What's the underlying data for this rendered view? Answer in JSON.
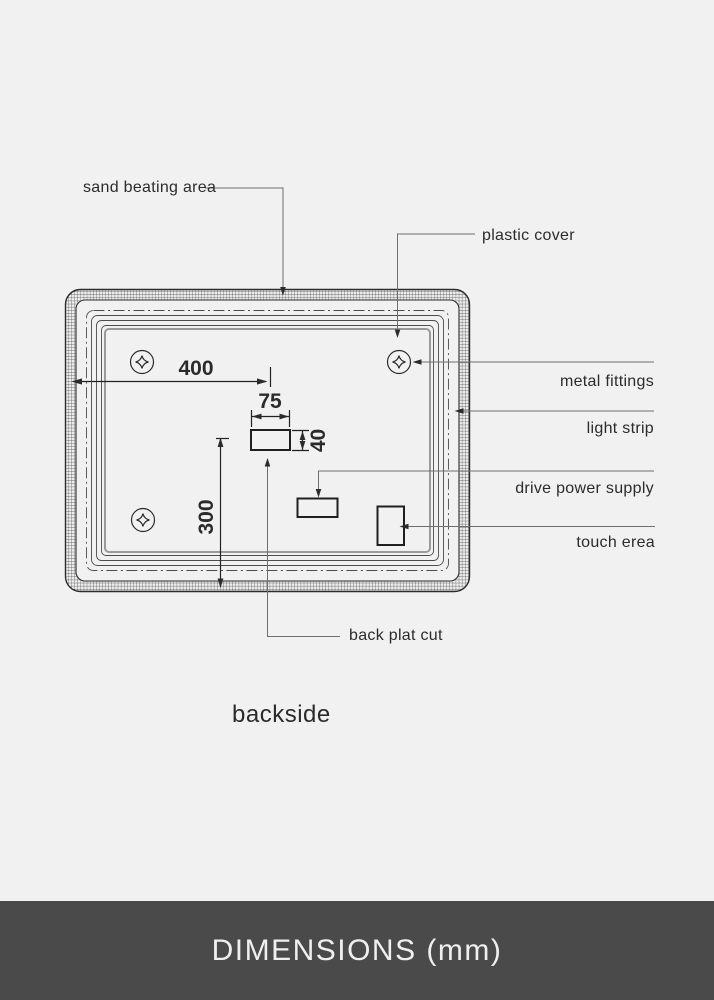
{
  "colors": {
    "background": "#f1f1f2",
    "drawing_line_dark": "#2b2b2b",
    "drawing_line_gray": "#6e6e6e",
    "footer_background": "#4a4a4a",
    "footer_text": "#efefef"
  },
  "diagram": {
    "view_label": "backside",
    "callouts": {
      "sand_beating_area": {
        "label": "sand beating area"
      },
      "plastic_cover": {
        "label": "plastic cover"
      },
      "metal_fittings": {
        "label": "metal fittings"
      },
      "light_strip": {
        "label": "light strip"
      },
      "drive_power_supply": {
        "label": "drive power supply"
      },
      "touch_area": {
        "label": "touch erea"
      },
      "back_plate_cut": {
        "label": "back plat cut"
      }
    },
    "dimensions_mm": {
      "left_edge_to_cut_center": "400",
      "cut_width": "75",
      "cut_height": "40",
      "cut_center_to_bottom_edge": "300"
    }
  },
  "footer": {
    "title": "DIMENSIONS (mm)"
  }
}
